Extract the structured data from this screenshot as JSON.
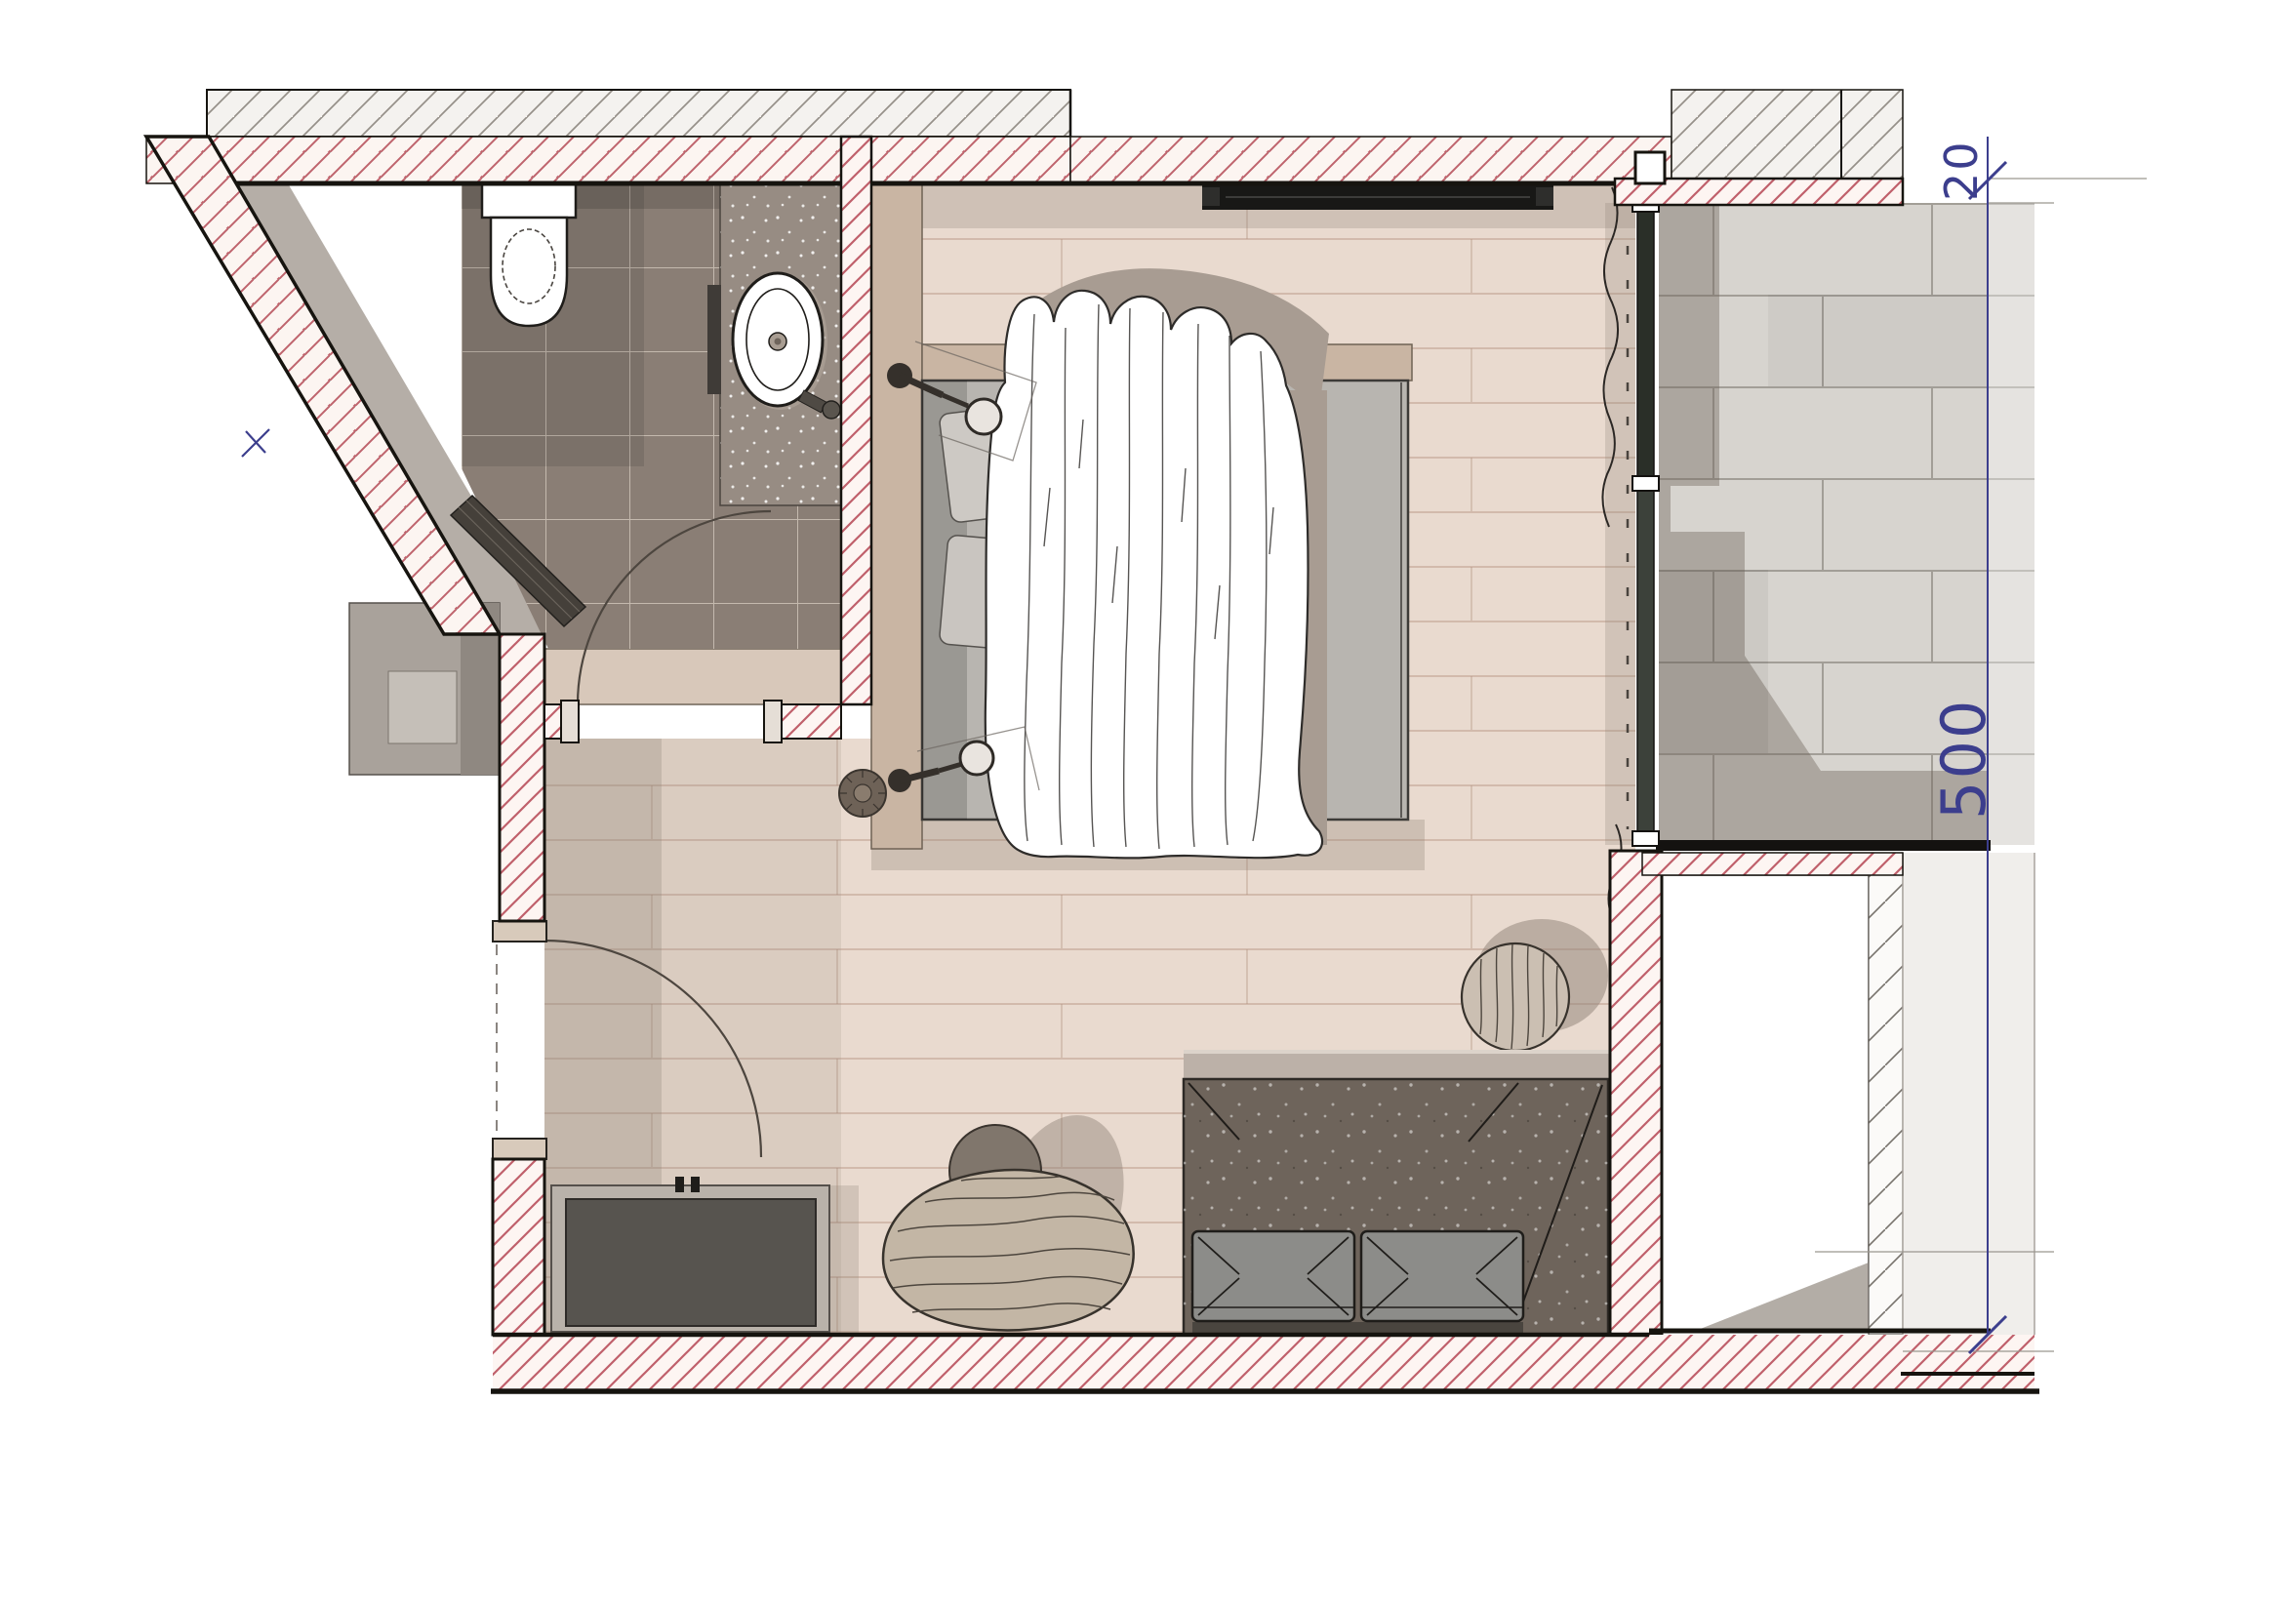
{
  "meta": {
    "title": "Hotel room floor plan – sketch render",
    "drawing_type": "architectural floor plan, top view",
    "paper_color": "#ffffff"
  },
  "dimensions": {
    "parapet_thickness": {
      "label": "20",
      "orientation": "vertical-rotated",
      "color": "#3c3e8d"
    },
    "terrace_depth": {
      "label": "500",
      "orientation": "vertical-rotated",
      "color": "#3c3e8d"
    }
  },
  "palette": {
    "wall_hatch_red": "#c0606b",
    "wall_hatch_gray": "#8f8a84",
    "wall_line": "#16140f",
    "wood_floor": "#e9dacf",
    "plank_line": "#b08e7c",
    "bath_tile": "#8a7e75",
    "bath_grout": "#c4b9ae",
    "counter_speckle": "#978c83",
    "headboard_wood": "#c9b5a3",
    "mattress": "#b8b5b0",
    "duvet": "#ffffff",
    "sofa_fabric": "#6e645b",
    "seat_cushion": "#8c8c89",
    "chair_wood": "#c3b6a5",
    "terrace_tile": "#d7d4cf",
    "shadow": "#8d8075",
    "dimension_blue": "#3c3e8d"
  },
  "rooms": {
    "bathroom": {
      "features": [
        "toilet",
        "vanity counter",
        "oval washbasin",
        "mirror",
        "bench along sloped wall"
      ]
    },
    "hallway": {
      "features": [
        "closet niche",
        "entry door swing",
        "bathroom door swing"
      ]
    },
    "bedroom": {
      "features": [
        "platform bed",
        "duvet",
        "two wall lamps",
        "bedside stool",
        "wall tv",
        "curtain track"
      ]
    },
    "lounge_area": {
      "features": [
        "sideboard",
        "organic lounge chair",
        "round cushion",
        "round side table",
        "rug",
        "sofa with two seat cushions"
      ]
    },
    "terrace": {
      "features": [
        "large format stone tiles",
        "parapet wall",
        "sliding glass door"
      ]
    },
    "void_room": {
      "features": [
        "empty white room",
        "corner shadow"
      ]
    }
  }
}
